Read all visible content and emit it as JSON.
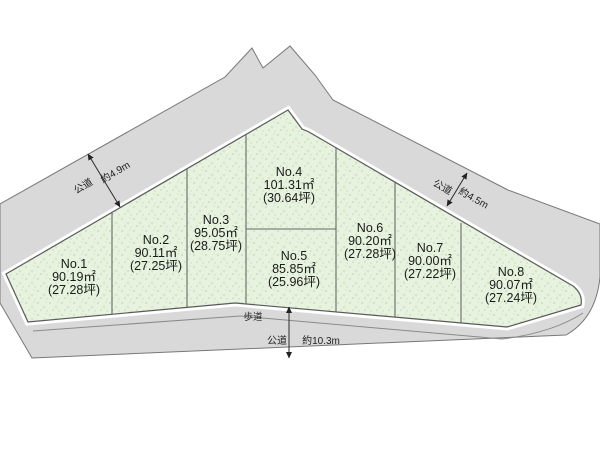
{
  "plots": [
    {
      "no": "No.1",
      "area": "90.19㎡",
      "tsubo": "(27.28坪)"
    },
    {
      "no": "No.2",
      "area": "90.11㎡",
      "tsubo": "(27.25坪)"
    },
    {
      "no": "No.3",
      "area": "95.05㎡",
      "tsubo": "(28.75坪)"
    },
    {
      "no": "No.4",
      "area": "101.31㎡",
      "tsubo": "(30.64坪)"
    },
    {
      "no": "No.5",
      "area": "85.85㎡",
      "tsubo": "(25.96坪)"
    },
    {
      "no": "No.6",
      "area": "90.20㎡",
      "tsubo": "(27.28坪)"
    },
    {
      "no": "No.7",
      "area": "90.00㎡",
      "tsubo": "(27.22坪)"
    },
    {
      "no": "No.8",
      "area": "90.07㎡",
      "tsubo": "(27.24坪)"
    }
  ],
  "roads": {
    "left": {
      "label": "公道",
      "width": "約4.9m"
    },
    "right": {
      "label": "公道",
      "width": "約4.5m"
    },
    "bottom": {
      "sidewalk_label": "歩道",
      "label": "公道",
      "width": "約10.3m"
    }
  },
  "colors": {
    "road_fill": "#d9d9d9",
    "parcel_fill": "#e7f2df",
    "outline": "#5a5a5a"
  }
}
